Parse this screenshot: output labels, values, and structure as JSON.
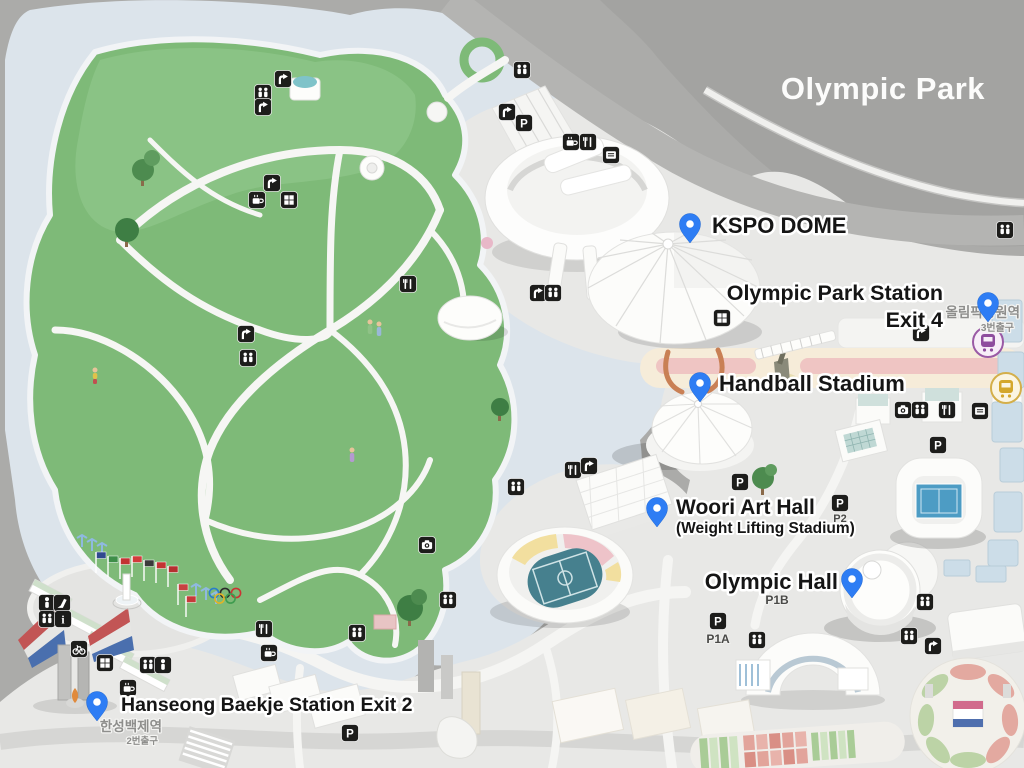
{
  "title": "Olympic Park",
  "markers": [
    {
      "name": "kspo-dome",
      "lines": [
        "KSPO DOME"
      ]
    },
    {
      "name": "olympic-park-station-exit-4",
      "lines": [
        "Olympic Park Station",
        "Exit 4"
      ]
    },
    {
      "name": "handball-stadium",
      "lines": [
        "Handball Stadium"
      ]
    },
    {
      "name": "woori-art-hall",
      "lines": [
        "Woori Art Hall",
        "(Weight Lifting Stadium)"
      ]
    },
    {
      "name": "olympic-hall",
      "lines": [
        "Olympic Hall"
      ]
    },
    {
      "name": "hanseong-baekje-station-exit-2",
      "lines": [
        "Hanseong Baekje Station Exit 2"
      ]
    }
  ],
  "korean_labels": [
    {
      "name": "olympic-park-station-korean",
      "lines": [
        "올림픽공원역",
        "3번출구"
      ]
    },
    {
      "name": "hanseong-baekje-station-korean",
      "lines": [
        "한성백제역",
        "2번출구"
      ]
    }
  ],
  "parking_labels": [
    "P2",
    "P1B",
    "P1A"
  ],
  "icons": [
    {
      "type": "restroom",
      "x": 522,
      "y": 70
    },
    {
      "type": "arrow",
      "x": 507,
      "y": 112
    },
    {
      "type": "parking",
      "x": 524,
      "y": 123
    },
    {
      "type": "cafe",
      "x": 571,
      "y": 142
    },
    {
      "type": "food",
      "x": 588,
      "y": 142
    },
    {
      "type": "ticket",
      "x": 611,
      "y": 155
    },
    {
      "type": "arrow",
      "x": 283,
      "y": 79
    },
    {
      "type": "restroom",
      "x": 263,
      "y": 93
    },
    {
      "type": "arrow",
      "x": 263,
      "y": 107
    },
    {
      "type": "arrow",
      "x": 272,
      "y": 183
    },
    {
      "type": "cafe",
      "x": 257,
      "y": 200
    },
    {
      "type": "locker",
      "x": 289,
      "y": 200
    },
    {
      "type": "arrow",
      "x": 246,
      "y": 334
    },
    {
      "type": "restroom",
      "x": 248,
      "y": 358
    },
    {
      "type": "food",
      "x": 408,
      "y": 284
    },
    {
      "type": "arrow",
      "x": 538,
      "y": 293
    },
    {
      "type": "restroom",
      "x": 553,
      "y": 293
    },
    {
      "type": "locker",
      "x": 722,
      "y": 318
    },
    {
      "type": "food",
      "x": 573,
      "y": 470
    },
    {
      "type": "arrow",
      "x": 589,
      "y": 466
    },
    {
      "type": "restroom",
      "x": 516,
      "y": 487
    },
    {
      "type": "camera",
      "x": 427,
      "y": 545
    },
    {
      "type": "parking",
      "x": 740,
      "y": 482
    },
    {
      "type": "parking",
      "x": 840,
      "y": 503
    },
    {
      "type": "parking",
      "x": 938,
      "y": 445
    },
    {
      "type": "parking",
      "x": 718,
      "y": 621
    },
    {
      "type": "parking",
      "x": 350,
      "y": 733
    },
    {
      "type": "camera",
      "x": 903,
      "y": 410
    },
    {
      "type": "restroom",
      "x": 920,
      "y": 410
    },
    {
      "type": "food",
      "x": 947,
      "y": 410
    },
    {
      "type": "ticket",
      "x": 980,
      "y": 411
    },
    {
      "type": "arrow",
      "x": 921,
      "y": 333
    },
    {
      "type": "restroom",
      "x": 1005,
      "y": 230
    },
    {
      "type": "restroom",
      "x": 357,
      "y": 633
    },
    {
      "type": "restroom",
      "x": 448,
      "y": 600
    },
    {
      "type": "food",
      "x": 264,
      "y": 629
    },
    {
      "type": "cafe",
      "x": 269,
      "y": 653
    },
    {
      "type": "bike",
      "x": 79,
      "y": 649
    },
    {
      "type": "person",
      "x": 47,
      "y": 603
    },
    {
      "type": "slide",
      "x": 62,
      "y": 603
    },
    {
      "type": "restroom",
      "x": 47,
      "y": 619
    },
    {
      "type": "info",
      "x": 63,
      "y": 619
    },
    {
      "type": "locker",
      "x": 105,
      "y": 663
    },
    {
      "type": "restroom",
      "x": 148,
      "y": 665
    },
    {
      "type": "person",
      "x": 163,
      "y": 665
    },
    {
      "type": "cafe",
      "x": 128,
      "y": 688
    },
    {
      "type": "restroom",
      "x": 925,
      "y": 602
    },
    {
      "type": "restroom",
      "x": 909,
      "y": 636
    },
    {
      "type": "arrow",
      "x": 933,
      "y": 646
    },
    {
      "type": "restroom",
      "x": 757,
      "y": 640
    }
  ],
  "flags": [
    {
      "x": 96,
      "y": 552,
      "color": "#30498f"
    },
    {
      "x": 108,
      "y": 556,
      "color": "#3e8e49"
    },
    {
      "x": 120,
      "y": 558,
      "color": "#c33333"
    },
    {
      "x": 132,
      "y": 556,
      "color": "#d23b3b"
    },
    {
      "x": 144,
      "y": 560,
      "color": "#3a3a3a"
    },
    {
      "x": 156,
      "y": 562,
      "color": "#c33333"
    },
    {
      "x": 168,
      "y": 566,
      "color": "#b53030"
    },
    {
      "x": 178,
      "y": 584,
      "color": "#c64040"
    },
    {
      "x": 186,
      "y": 596,
      "color": "#c63a3a"
    }
  ],
  "olympic_ring_colors": [
    "#2a7ec9",
    "#2b2b2b",
    "#cc3333",
    "#e0b428",
    "#3f9c4f"
  ],
  "colors": {
    "background": "#ababa9",
    "background_dark": "#a2a2a0",
    "halo": "#dce4eb",
    "plaza": "#e8e8e6",
    "road": "#b4b4b2",
    "park_green": "#7eba78",
    "park_green_light": "#8fc689",
    "tree_green": "#3e7e44",
    "pin_blue": "#2e7df4",
    "label_text": "#151515",
    "label_halo": "#ffffff",
    "korean_text": "#8e8e8c",
    "pink_road": "#efc5c3",
    "cream_band": "#f6ecd9",
    "stadium_field_teal": "#46808e",
    "tennis_court_blue": "#4d9cc4",
    "gate_red": "#c25555",
    "gate_blue": "#4a6fae",
    "metro_purple": "#8e4d9e",
    "metro_yellow": "#d4a72c",
    "icon_black": "#1d1d1b"
  }
}
